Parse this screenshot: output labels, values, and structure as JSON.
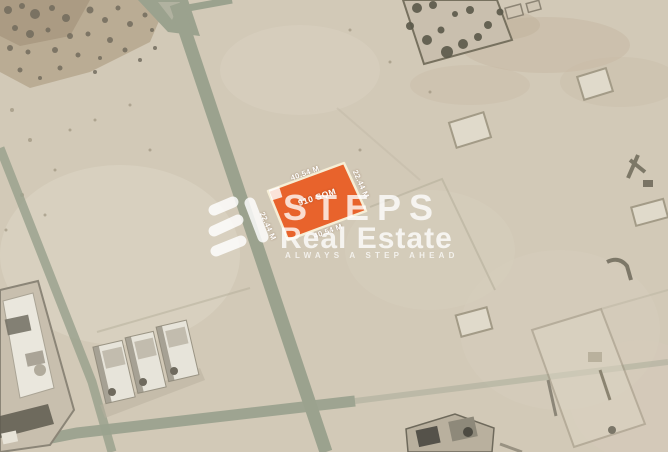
{
  "listing_map": {
    "plot": {
      "area": "910 SQM",
      "dimensions": {
        "top": "40.54 M",
        "bottom": "40.54 M",
        "left": "22.44 M",
        "right": "22.44 M"
      },
      "highlight_fill": "#e8632c",
      "highlight_border": "#f6eed6"
    },
    "watermark": {
      "brand_word_top": "STEPS",
      "brand_word_bottom": "Real Estate",
      "tagline": "ALWAYS A STEP AHEAD",
      "icon": "steps-zigzag-logo"
    },
    "map_style": {
      "sand": "#d2c9b7",
      "road": "#9ba28e"
    }
  }
}
